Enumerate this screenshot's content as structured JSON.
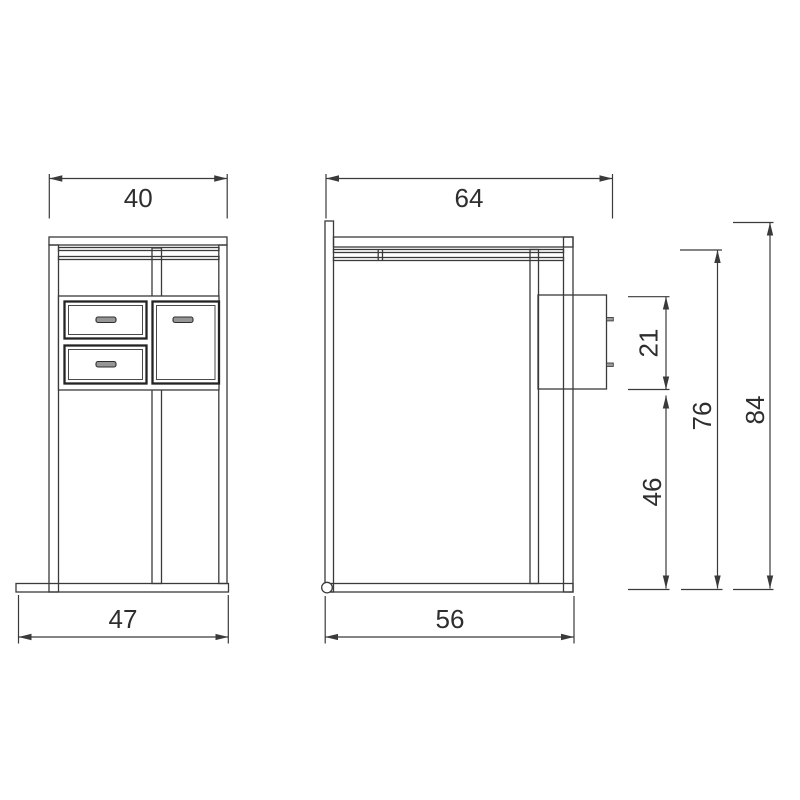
{
  "front_view": {
    "top_width_label": "40",
    "base_width_label": "47"
  },
  "side_view": {
    "top_width_label": "64",
    "base_width_label": "56",
    "upper_box_height_label": "21",
    "lower_section_height_label": "46",
    "frame_height_label": "76",
    "total_height_label": "84"
  },
  "colors": {
    "line": "#3a3a3a",
    "background": "#ffffff",
    "handle_fill": "#969696",
    "pin_fill": "#9c9c9c"
  }
}
